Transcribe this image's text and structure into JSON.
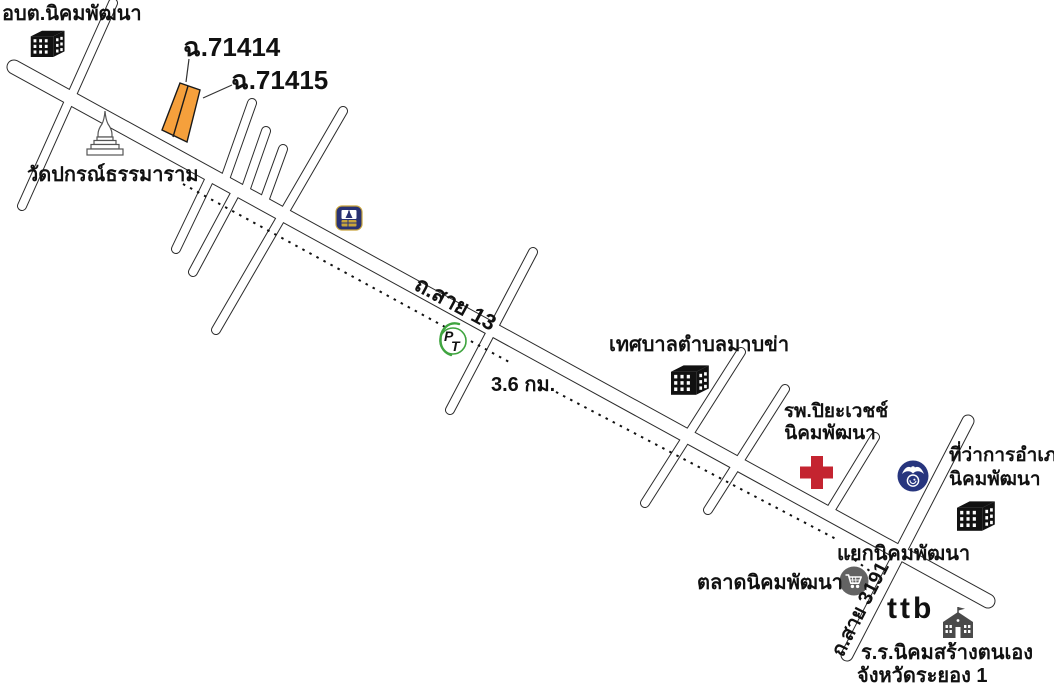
{
  "map": {
    "title_hint": "hand-drawn Thai location map",
    "background": "#ffffff",
    "labels": {
      "subdistrict_office": "อบต.นิคมพัฒนา",
      "temple": "วัดปกรณ์ธรรมาราม",
      "parcel_1": "ฉ.71414",
      "parcel_2": "ฉ.71415",
      "road_13": "ถ.สาย 13",
      "distance": "3.6 กม.",
      "municipality": "เทศบาลตำบลมาบข่า",
      "hospital_line1": "รพ.ปิยะเวชช์",
      "hospital_line2": "นิคมพัฒนา",
      "district_office_line1": "ที่ว่าการอำเภอ",
      "district_office_line2": "นิคมพัฒนา",
      "junction": "แยกนิคมพัฒนา",
      "market": "ตลาดนิคมพัฒนา",
      "road_3191": "ถ.สาย 3191",
      "school_line1": "ร.ร.นิคมสร้างตนเอง",
      "school_line2": "จังหวัดระยอง 1"
    },
    "ttb_logo": {
      "t1": "t",
      "t2": "t",
      "b": "b"
    },
    "pt_logo": {
      "p": "P",
      "t": "T"
    },
    "colors": {
      "road_outline": "#2b2b2b",
      "road_fill": "#ffffff",
      "dotted_line": "#111111",
      "parcel_fill": "#F5A03C",
      "parcel_label_red": "#ED1C24",
      "cross_red": "#C42430",
      "seal_navy": "#27357E",
      "bbl_navy": "#283173",
      "bbl_gold": "#C9A53C",
      "ttb_navy": "#1F3767",
      "ttb_orange": "#F68B1F",
      "ttb_blue": "#2F6FB5",
      "pt_green": "#3FA43F",
      "pt_red": "#D81F26",
      "market_gray": "#636363",
      "school_gray": "#4A4A4A",
      "building_black": "#111111",
      "temple_stroke": "#555555"
    }
  }
}
